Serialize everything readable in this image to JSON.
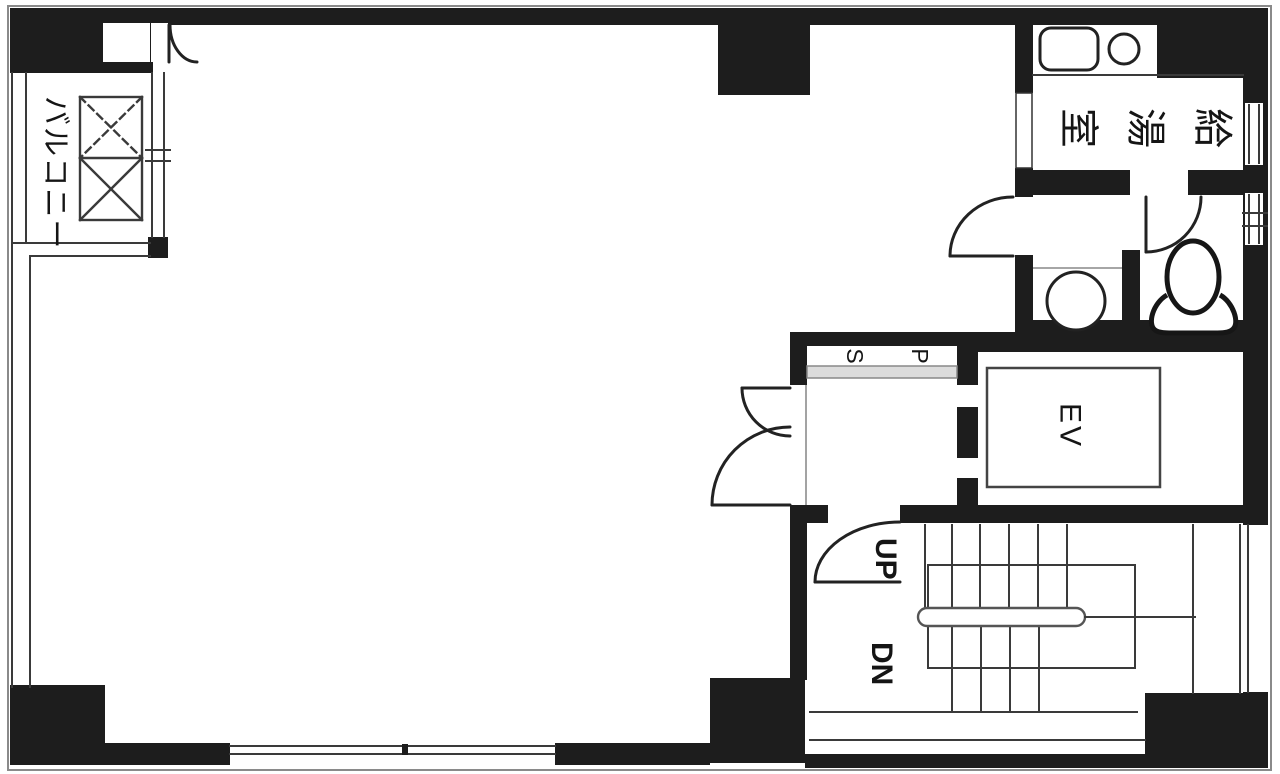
{
  "plan": {
    "type_note": "building floor plan",
    "colors": {
      "wall": "#1d1d1d",
      "line": "#3a3a3a",
      "light": "#8a8a8a",
      "sill": "#dcdcdc",
      "paper": "#ffffff"
    }
  },
  "rooms": {
    "balcony": {
      "label": "バルコニー"
    },
    "kitchenette": {
      "label": "給湯室",
      "chars": [
        "給",
        "湯",
        "室"
      ]
    },
    "elevator": {
      "label": "EV"
    },
    "pipe_space": {
      "label": "PS",
      "chars": [
        "P",
        "S"
      ]
    },
    "stairs": {
      "up_label": "UP",
      "down_label": "DN"
    }
  }
}
